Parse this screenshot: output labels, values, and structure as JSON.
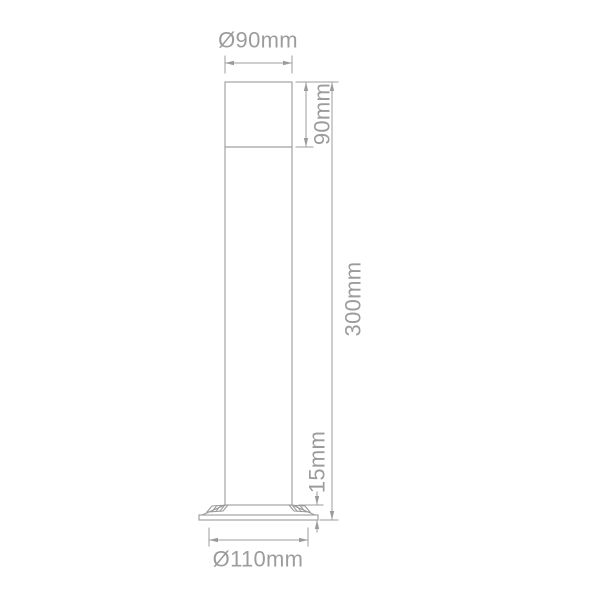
{
  "colors": {
    "line": "#9c9c9c",
    "text": "#9c9c9c",
    "background": "#ffffff"
  },
  "dims": {
    "top_diameter": "Ø90mm",
    "head_height": "90mm",
    "overall_height": "300mm",
    "base_height": "15mm",
    "base_diameter": "Ø110mm"
  }
}
